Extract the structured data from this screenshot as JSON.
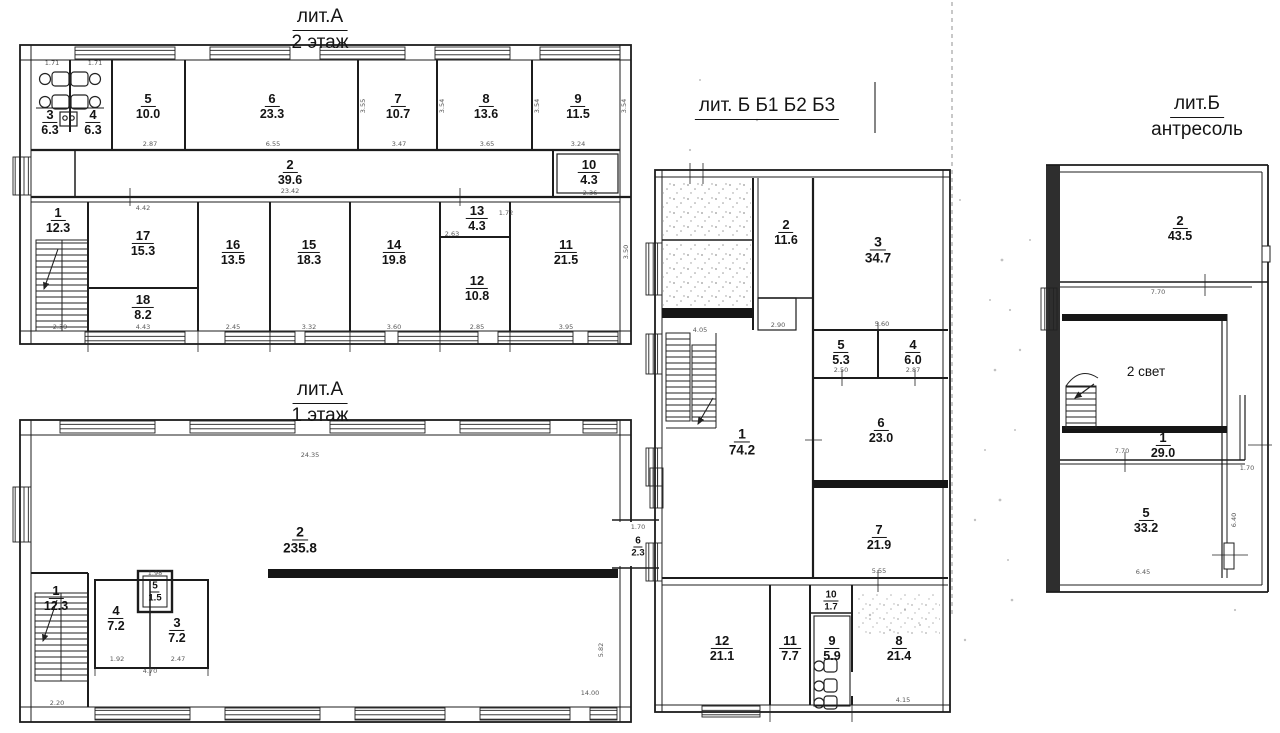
{
  "document": {
    "kind": "scanned floor plan",
    "language": "ru"
  },
  "colors": {
    "paper": "#ffffff",
    "ink": "#1c1c1c"
  },
  "plans": [
    {
      "id": "litA2",
      "title1": "лит.А",
      "title2": "2 этаж",
      "rooms": [
        {
          "n": "3",
          "a": "6.3",
          "x": 50,
          "y": 122
        },
        {
          "n": "4",
          "a": "6.3",
          "x": 93,
          "y": 122
        },
        {
          "n": "5",
          "a": "10.0",
          "x": 148,
          "y": 106
        },
        {
          "n": "6",
          "a": "23.3",
          "x": 272,
          "y": 106
        },
        {
          "n": "7",
          "a": "10.7",
          "x": 398,
          "y": 106
        },
        {
          "n": "8",
          "a": "13.6",
          "x": 486,
          "y": 106
        },
        {
          "n": "9",
          "a": "11.5",
          "x": 578,
          "y": 106
        },
        {
          "n": "2",
          "a": "39.6",
          "x": 290,
          "y": 172
        },
        {
          "n": "10",
          "a": "4.3",
          "x": 589,
          "y": 172
        },
        {
          "n": "1",
          "a": "12.3",
          "x": 58,
          "y": 220
        },
        {
          "n": "17",
          "a": "15.3",
          "x": 143,
          "y": 243
        },
        {
          "n": "18",
          "a": "8.2",
          "x": 143,
          "y": 307
        },
        {
          "n": "16",
          "a": "13.5",
          "x": 233,
          "y": 252
        },
        {
          "n": "15",
          "a": "18.3",
          "x": 309,
          "y": 252
        },
        {
          "n": "14",
          "a": "19.8",
          "x": 394,
          "y": 252
        },
        {
          "n": "13",
          "a": "4.3",
          "x": 477,
          "y": 218
        },
        {
          "n": "12",
          "a": "10.8",
          "x": 477,
          "y": 288
        },
        {
          "n": "11",
          "a": "21.5",
          "x": 566,
          "y": 252
        }
      ]
    },
    {
      "id": "litA1",
      "title1": "лит.А",
      "title2": "1 этаж",
      "rooms": [
        {
          "n": "2",
          "a": "235.8",
          "x": 300,
          "y": 540,
          "size": "big"
        },
        {
          "n": "1",
          "a": "12.3",
          "x": 56,
          "y": 598
        },
        {
          "n": "4",
          "a": "7.2",
          "x": 116,
          "y": 618
        },
        {
          "n": "5",
          "a": "1.5",
          "x": 155,
          "y": 590,
          "size": "small"
        },
        {
          "n": "3",
          "a": "7.2",
          "x": 177,
          "y": 630
        },
        {
          "n": "6",
          "a": "2.3",
          "x": 638,
          "y": 545,
          "size": "small"
        }
      ]
    },
    {
      "id": "litB",
      "title1": "лит. Б Б1 Б2 Б3",
      "title2": "",
      "rooms": [
        {
          "n": "2",
          "a": "11.6",
          "x": 786,
          "y": 232
        },
        {
          "n": "3",
          "a": "34.7",
          "x": 878,
          "y": 250,
          "size": "big"
        },
        {
          "n": "5",
          "a": "5.3",
          "x": 841,
          "y": 352
        },
        {
          "n": "4",
          "a": "6.0",
          "x": 913,
          "y": 352
        },
        {
          "n": "6",
          "a": "23.0",
          "x": 881,
          "y": 430
        },
        {
          "n": "1",
          "a": "74.2",
          "x": 742,
          "y": 442,
          "size": "big"
        },
        {
          "n": "7",
          "a": "21.9",
          "x": 879,
          "y": 537
        },
        {
          "n": "12",
          "a": "21.1",
          "x": 722,
          "y": 648
        },
        {
          "n": "11",
          "a": "7.7",
          "x": 790,
          "y": 648
        },
        {
          "n": "10",
          "a": "1.7",
          "x": 831,
          "y": 599,
          "size": "small"
        },
        {
          "n": "9",
          "a": "5.9",
          "x": 832,
          "y": 648
        },
        {
          "n": "8",
          "a": "21.4",
          "x": 899,
          "y": 648
        }
      ]
    },
    {
      "id": "litB_antresol",
      "title1": "лит.Б",
      "title2": "антресоль",
      "rooms": [
        {
          "n": "2",
          "a": "43.5",
          "x": 1180,
          "y": 228
        },
        {
          "text": "2 свет",
          "x": 1146,
          "y": 372
        },
        {
          "n": "1",
          "a": "29.0",
          "x": 1163,
          "y": 445
        },
        {
          "n": "5",
          "a": "33.2",
          "x": 1146,
          "y": 520
        }
      ]
    }
  ],
  "dimensions": [
    {
      "t": "1.71",
      "x": 52,
      "y": 63
    },
    {
      "t": "1.71",
      "x": 95,
      "y": 63
    },
    {
      "t": "2.87",
      "x": 150,
      "y": 144
    },
    {
      "t": "6.55",
      "x": 273,
      "y": 144
    },
    {
      "t": "3.47",
      "x": 399,
      "y": 144
    },
    {
      "t": "3.65",
      "x": 487,
      "y": 144
    },
    {
      "t": "3.24",
      "x": 578,
      "y": 144
    },
    {
      "t": "3.55",
      "x": 363,
      "y": 106,
      "v": 1
    },
    {
      "t": "3.54",
      "x": 442,
      "y": 106,
      "v": 1
    },
    {
      "t": "3.54",
      "x": 537,
      "y": 106,
      "v": 1
    },
    {
      "t": "3.54",
      "x": 624,
      "y": 106,
      "v": 1
    },
    {
      "t": "23.42",
      "x": 290,
      "y": 191
    },
    {
      "t": "2.36",
      "x": 590,
      "y": 193
    },
    {
      "t": "4.42",
      "x": 143,
      "y": 208
    },
    {
      "t": "2.63",
      "x": 452,
      "y": 234
    },
    {
      "t": "1.72",
      "x": 506,
      "y": 213
    },
    {
      "t": "2.39",
      "x": 60,
      "y": 327
    },
    {
      "t": "4.43",
      "x": 143,
      "y": 327
    },
    {
      "t": "2.45",
      "x": 233,
      "y": 327
    },
    {
      "t": "3.32",
      "x": 309,
      "y": 327
    },
    {
      "t": "3.60",
      "x": 394,
      "y": 327
    },
    {
      "t": "2.85",
      "x": 477,
      "y": 327
    },
    {
      "t": "3.95",
      "x": 566,
      "y": 327
    },
    {
      "t": "3.50",
      "x": 626,
      "y": 252,
      "v": 1
    },
    {
      "t": "24.35",
      "x": 310,
      "y": 455
    },
    {
      "t": "1.98",
      "x": 155,
      "y": 573
    },
    {
      "t": "1.92",
      "x": 117,
      "y": 659
    },
    {
      "t": "2.47",
      "x": 178,
      "y": 659
    },
    {
      "t": "4.70",
      "x": 150,
      "y": 671
    },
    {
      "t": "2.20",
      "x": 57,
      "y": 703
    },
    {
      "t": "5.82",
      "x": 601,
      "y": 650,
      "v": 1
    },
    {
      "t": "14.00",
      "x": 590,
      "y": 693
    },
    {
      "t": "1.70",
      "x": 638,
      "y": 527
    },
    {
      "t": "4.05",
      "x": 700,
      "y": 330
    },
    {
      "t": "2.90",
      "x": 778,
      "y": 325
    },
    {
      "t": "5.60",
      "x": 882,
      "y": 324
    },
    {
      "t": "2.50",
      "x": 841,
      "y": 370
    },
    {
      "t": "2.87",
      "x": 913,
      "y": 370
    },
    {
      "t": "5.55",
      "x": 879,
      "y": 571
    },
    {
      "t": "4.15",
      "x": 903,
      "y": 700
    },
    {
      "t": "7.70",
      "x": 1158,
      "y": 292
    },
    {
      "t": "7.70",
      "x": 1122,
      "y": 451
    },
    {
      "t": "6.45",
      "x": 1143,
      "y": 572
    },
    {
      "t": "1.70",
      "x": 1247,
      "y": 468
    },
    {
      "t": "6.40",
      "x": 1234,
      "y": 520,
      "v": 1
    }
  ]
}
